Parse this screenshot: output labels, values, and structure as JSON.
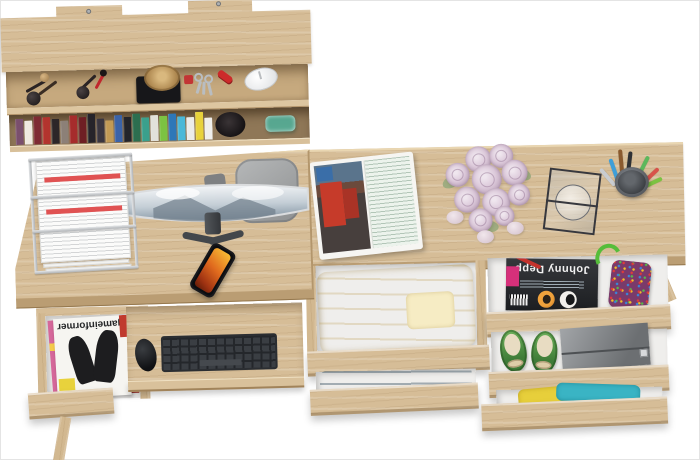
{
  "scene": {
    "subject": "top-down 3d render of oak home-office furniture set: wall shelf, computer desk and dressing table with open drawers"
  },
  "colors": {
    "background": "#ffffff",
    "wood": "#d6bd97",
    "wood_shadow": "#b4976e",
    "wood_edge": "#c8ab80",
    "drawer_interior": "#efeeec",
    "paper_accent_red": "#e05252",
    "keyboard": "#3a3e43",
    "chair_gray": "#a7a9aa",
    "phone_screen_orange": "#e06a1e",
    "rose_pink": "#dcc9da",
    "clothes_yellow": "#f0dfa4",
    "clothes_blue": "#4c7890",
    "clothes_gold": "#e7cf3b",
    "clothes_cyan": "#3ab4c4",
    "shoes_green": "#57a04b",
    "clutch_gray": "#85888b",
    "magazine_badge_pink": "#d6307a",
    "teal_glass": "#46b8a4"
  },
  "shelf": {
    "mount_count": 2,
    "upper_items": [
      "makeup-brushes",
      "lipstick-and-brush",
      "straw-hat-on-black-box",
      "keys-with-red-fob",
      "red-pocket-knife",
      "white-computer-mouse"
    ],
    "lower_items": [
      "book-row",
      "dark-beanie",
      "teal-glass"
    ],
    "books": [
      {
        "c": "#7a4f6d",
        "h": 26
      },
      {
        "c": "#efe9e0",
        "h": 24
      },
      {
        "c": "#7e2b33",
        "h": 28
      },
      {
        "c": "#b3342e",
        "h": 27
      },
      {
        "c": "#2c2628",
        "h": 25
      },
      {
        "c": "#8c8077",
        "h": 23
      },
      {
        "c": "#a62c2c",
        "h": 28
      },
      {
        "c": "#6e1f24",
        "h": 26
      },
      {
        "c": "#26242a",
        "h": 29
      },
      {
        "c": "#3a3640",
        "h": 24
      },
      {
        "c": "#c29a55",
        "h": 22
      },
      {
        "c": "#3b63a8",
        "h": 27
      },
      {
        "c": "#23242a",
        "h": 25
      },
      {
        "c": "#2c6e4f",
        "h": 28
      },
      {
        "c": "#3aa08c",
        "h": 24
      },
      {
        "c": "#e2e1da",
        "h": 26
      },
      {
        "c": "#7cc242",
        "h": 25
      },
      {
        "c": "#2e77b8",
        "h": 27
      },
      {
        "c": "#49b8d8",
        "h": 24
      },
      {
        "c": "#ececea",
        "h": 23
      },
      {
        "c": "#e8d23c",
        "h": 28
      },
      {
        "c": "#f0efec",
        "h": 22
      }
    ]
  },
  "left_desk": {
    "paper_tray": {
      "tiers": 3,
      "contents": "stacked white documents with red header bars"
    },
    "monitor": {
      "type": "curved-widescreen",
      "wallpaper": "mountains-and-clouds"
    },
    "chair": "gray office chair seen from top",
    "phone": "smartphone with orange artwork on screen",
    "keyboard": "dark wireless keyboard on pull-out tray",
    "mouse": "black wireless mouse",
    "drawer": {
      "magazine_title": "gameinformer",
      "other_items": [
        "pink magazine",
        "red-spine magazine"
      ]
    }
  },
  "right_desk": {
    "open_magazine": {
      "left_page": "photo of red building",
      "right_page": "text page"
    },
    "roses": {
      "color_name": "pale lilac roses",
      "blooms": [
        {
          "x": 26,
          "y": 2,
          "s": 26
        },
        {
          "x": 50,
          "y": 0,
          "s": 24
        },
        {
          "x": 6,
          "y": 18,
          "s": 24
        },
        {
          "x": 32,
          "y": 20,
          "s": 30
        },
        {
          "x": 62,
          "y": 16,
          "s": 26
        },
        {
          "x": 14,
          "y": 42,
          "s": 26
        },
        {
          "x": 42,
          "y": 44,
          "s": 28
        },
        {
          "x": 68,
          "y": 40,
          "s": 22
        },
        {
          "x": 28,
          "y": 64,
          "s": 24
        },
        {
          "x": 54,
          "y": 62,
          "s": 20
        }
      ]
    },
    "stones_count": 3,
    "mirror": "tilted glass frame",
    "pen_cup": {
      "pens": [
        {
          "c": "#5cb85c",
          "x": 22,
          "y": -2,
          "l": 30,
          "r": 28
        },
        {
          "c": "#3f9fd8",
          "x": 6,
          "y": 2,
          "l": 26,
          "r": -18
        },
        {
          "c": "#2e3135",
          "x": 14,
          "y": -4,
          "l": 32,
          "r": 8
        },
        {
          "c": "#c9ccd0",
          "x": 2,
          "y": 8,
          "l": 22,
          "r": -40
        },
        {
          "c": "#d8524a",
          "x": 28,
          "y": 6,
          "l": 24,
          "r": 48
        },
        {
          "c": "#8a5a2e",
          "x": 10,
          "y": -6,
          "l": 30,
          "r": -4
        },
        {
          "c": "#7cc242",
          "x": 31,
          "y": 12,
          "l": 20,
          "r": 66
        }
      ]
    },
    "drawers": {
      "a1_contents": "folded yellow clothes",
      "a2_contents": "folded blue clothes",
      "b1": {
        "magazine_title": "Johnny Depp",
        "items": [
          "beaded bag with green strap",
          "red pen"
        ]
      },
      "b2_contents": [
        "green ballet flats with bows",
        "gray clutch"
      ],
      "b3_contents": "gold and cyan clothes"
    }
  }
}
